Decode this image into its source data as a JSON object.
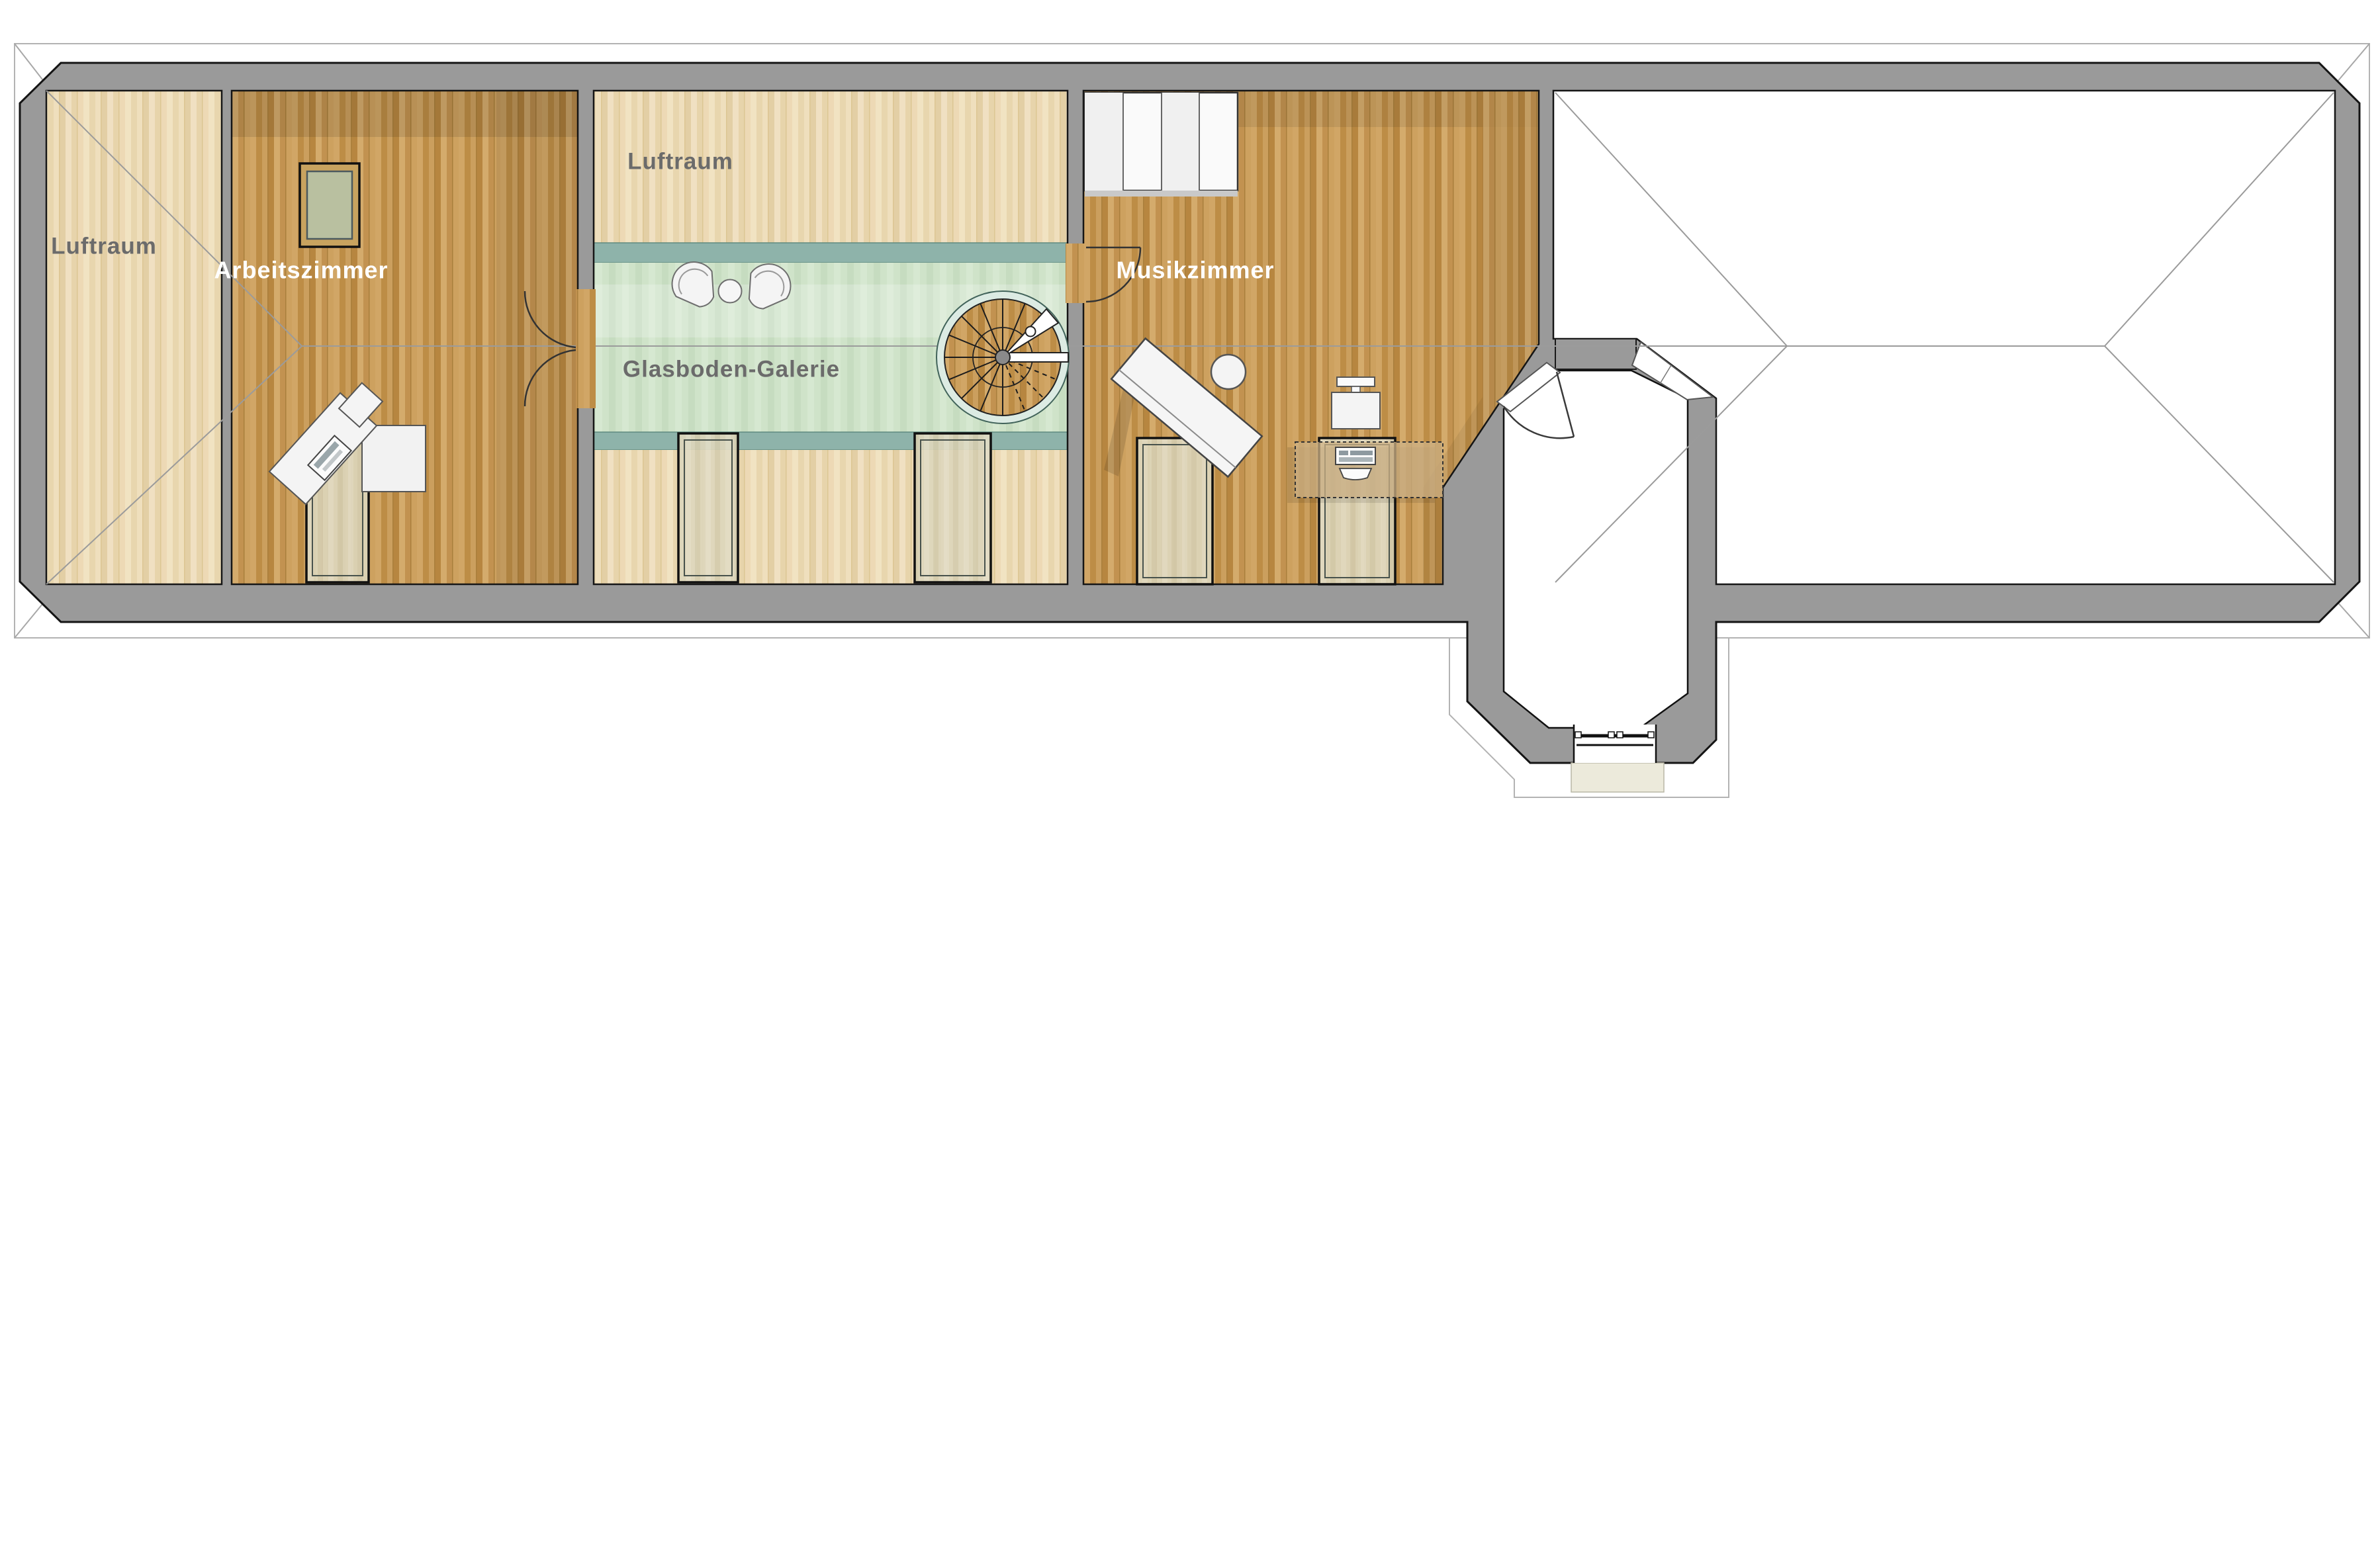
{
  "plan": {
    "kind": "architectural-floor-plan",
    "labels": {
      "luftraum_left": "Luftraum",
      "arbeitszimmer": "Arbeitszimmer",
      "luftraum_middle": "Luftraum",
      "glasboden_galerie": "Glasboden-Galerie",
      "musikzimmer": "Musikzimmer"
    },
    "rooms": [
      {
        "id": "luftraum-left",
        "label": "Luftraum"
      },
      {
        "id": "arbeitszimmer",
        "label": "Arbeitszimmer"
      },
      {
        "id": "luftraum-middle",
        "label": "Luftraum"
      },
      {
        "id": "glasboden-galerie",
        "label": "Glasboden-Galerie"
      },
      {
        "id": "musikzimmer",
        "label": "Musikzimmer"
      }
    ],
    "features": [
      "spiral-staircase",
      "glass-floor-gallery",
      "double-door",
      "roof-skylights",
      "octagonal-bay-tower",
      "wardrobe",
      "piano",
      "desks",
      "armchairs"
    ],
    "colors": {
      "wall": "#9a9a9a",
      "wall_edge": "#161616",
      "light_parquet": "#ecd9b0",
      "oak_parquet": "#c79a58",
      "glass_floor": "#cfe3c9",
      "gallery_parapet": "#8eb3aa",
      "roof_line": "#9b9b9b",
      "eave_line": "#b3b3b3",
      "label_gray": "#6b6b6b",
      "label_white": "#ffffff"
    }
  }
}
